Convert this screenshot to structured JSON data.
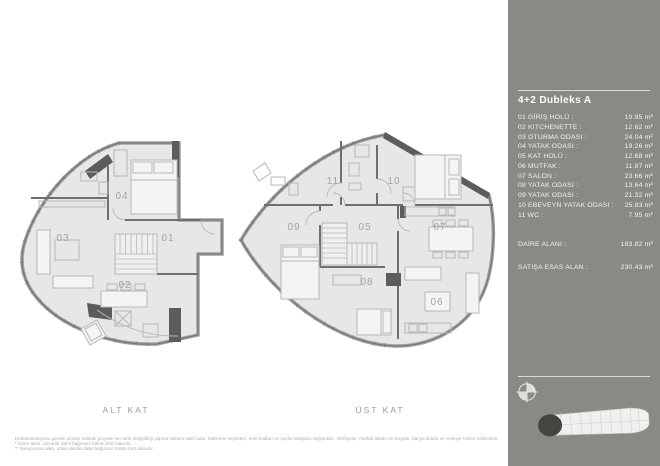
{
  "panel": {
    "title": "4+2 Dubleks A",
    "rows": [
      {
        "label": "01 GİRİŞ HOLÜ :",
        "value": "10.95 m²"
      },
      {
        "label": "02 KITCHENETTE :",
        "value": "12.62 m²"
      },
      {
        "label": "03 OTURMA ODASI :",
        "value": "24.04 m²"
      },
      {
        "label": "04 YATAK ODASI :",
        "value": "19.26 m²"
      },
      {
        "label": "05 KAT HOLÜ :",
        "value": "12.68 m²"
      },
      {
        "label": "06 MUTFAK :",
        "value": "11.87 m²"
      },
      {
        "label": "07 SALON :",
        "value": "23.66 m²"
      },
      {
        "label": "08 YATAK ODASI :",
        "value": "13.64 m²"
      },
      {
        "label": "09 YATAK ODASI :",
        "value": "21.32 m²"
      },
      {
        "label": "10 EBEVEYN YATAK ODASI :",
        "value": "25.83 m²"
      },
      {
        "label": "11 WC :",
        "value": "7.95 m²"
      }
    ],
    "totals": [
      {
        "label": "DAİRE ALANI :",
        "value": "183.82 m²"
      },
      {
        "label": "SATIŞA ESAS ALAN :",
        "value": "230.43 m²"
      }
    ]
  },
  "plans": {
    "lower": {
      "caption": "ALT KAT",
      "rooms": {
        "r01": "01",
        "r02": "02",
        "r03": "03",
        "r04": "04"
      }
    },
    "upper": {
      "caption": "ÜST KAT",
      "rooms": {
        "r05": "05",
        "r06": "06",
        "r07": "07",
        "r08": "08",
        "r09": "09",
        "r10": "10",
        "r11": "11"
      }
    }
  },
  "footer": {
    "disclaimer": "Dokümantasyonu gerekli olması halinde projede her türlü değişikliği yapma hakkını saklı tutar. Malzeme seçimleri, renk kodları ve cephe detayları değişebilir. Vitrifiyeler, mutfak dolabı ve tezgahı, banyo dolabı ve vestiyer teslim edilecektir.",
    "note1": "* Daire alanı, duvarlar dahil bağımsız bölüm brüt alanıdır.",
    "note2": "** Satışa esas alan, ortak alanlar dahil bağımsız bölüm brüt alanıdır."
  },
  "colors": {
    "panel_bg": "#8a8a85",
    "panel_text": "#f2f2ef",
    "floor": "#e7e7e5",
    "wall": "#6f6f6d",
    "wall_dark": "#5c5c5a",
    "room_label": "#a3a3a1",
    "caption": "#9b9b99",
    "footer_text": "#a9a9a7"
  }
}
